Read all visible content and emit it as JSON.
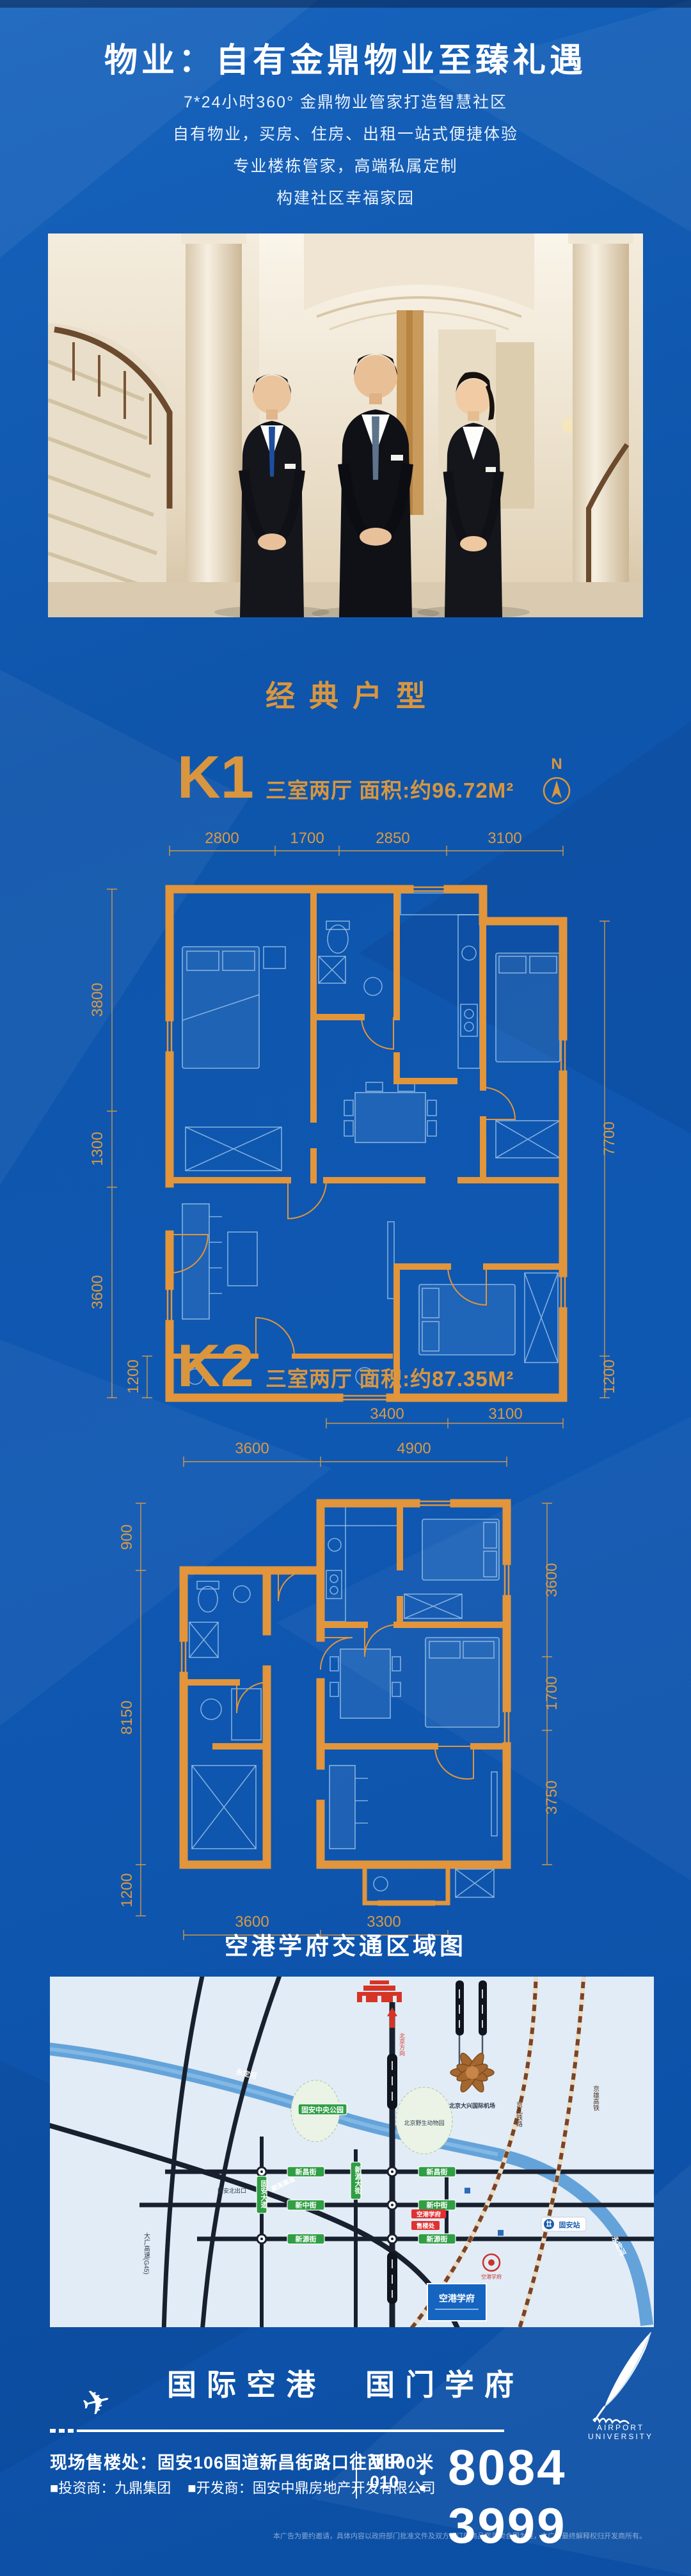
{
  "header": {
    "title": "物业：自有金鼎物业至臻礼遇",
    "lines": [
      "7*24小时360° 金鼎物业管家打造智慧社区",
      "自有物业，买房、住房、出租一站式便捷体验",
      "专业楼栋管家，高端私属定制",
      "构建社区幸福家园"
    ]
  },
  "sections": {
    "classic": "经典户型",
    "map_title": "空港学府交通区域图"
  },
  "k1": {
    "code": "K1",
    "desc": "三室两厅 面积:约96.72M²",
    "compass_n": "N",
    "dims": {
      "top": [
        "2800",
        "1700",
        "2850",
        "3100"
      ],
      "left": [
        "3800",
        "1300",
        "3600"
      ],
      "left_inner": "1200",
      "right": [
        "7700"
      ],
      "right_inner": "1200",
      "bottom": [
        "3400",
        "3100"
      ]
    }
  },
  "k2": {
    "code": "K2",
    "desc": "三室两厅 面积:约87.35M²",
    "dims": {
      "top": [
        "3600",
        "4900"
      ],
      "left": [
        "900",
        "8150",
        "1200"
      ],
      "right": [
        "3600",
        "1700",
        "3750"
      ],
      "bottom": [
        "3600",
        "3300"
      ]
    }
  },
  "map": {
    "labels": {
      "to_beijing": "北京方向",
      "airport": "北京大兴国际机场",
      "river": "永定河",
      "rail_jingjiu": "京九铁路",
      "rail_jingxiong": "京雄高铁",
      "hwy_dg": "大广高速(G45)",
      "hwy_lz": "廊涿高速",
      "exit": "固安北出口",
      "park_central": "固安中央公园",
      "park_wildlife": "北京野生动物园",
      "st_xinchang": "新昌街",
      "st_xinzhong": "新中街",
      "st_xinyuan": "新源街",
      "ave_guan": "固安大道",
      "ave_xinyuan": "新源大街",
      "tag_project": "空港学府",
      "tag_sales": "售楼处",
      "station": "固安站",
      "billboard": "空港学府"
    }
  },
  "slogan": "国际空港　国门学府",
  "brand": {
    "caption": "AIRPORT UNIVERSITY"
  },
  "footer": {
    "address": "现场售楼处：固安106国道新昌街路口往西800米",
    "investor": "■投资商：九鼎集团",
    "developer": "■开发商：固安中鼎房地产开发有限公司",
    "vip": "VIP",
    "code": "010",
    "colon": "：",
    "phone": "8084 3999",
    "disclaimer": "本广告为要约邀请，具体内容以政府部门批准文件及双方签订的商品房买卖合同为准，本广告最终解释权归开发商所有。"
  }
}
